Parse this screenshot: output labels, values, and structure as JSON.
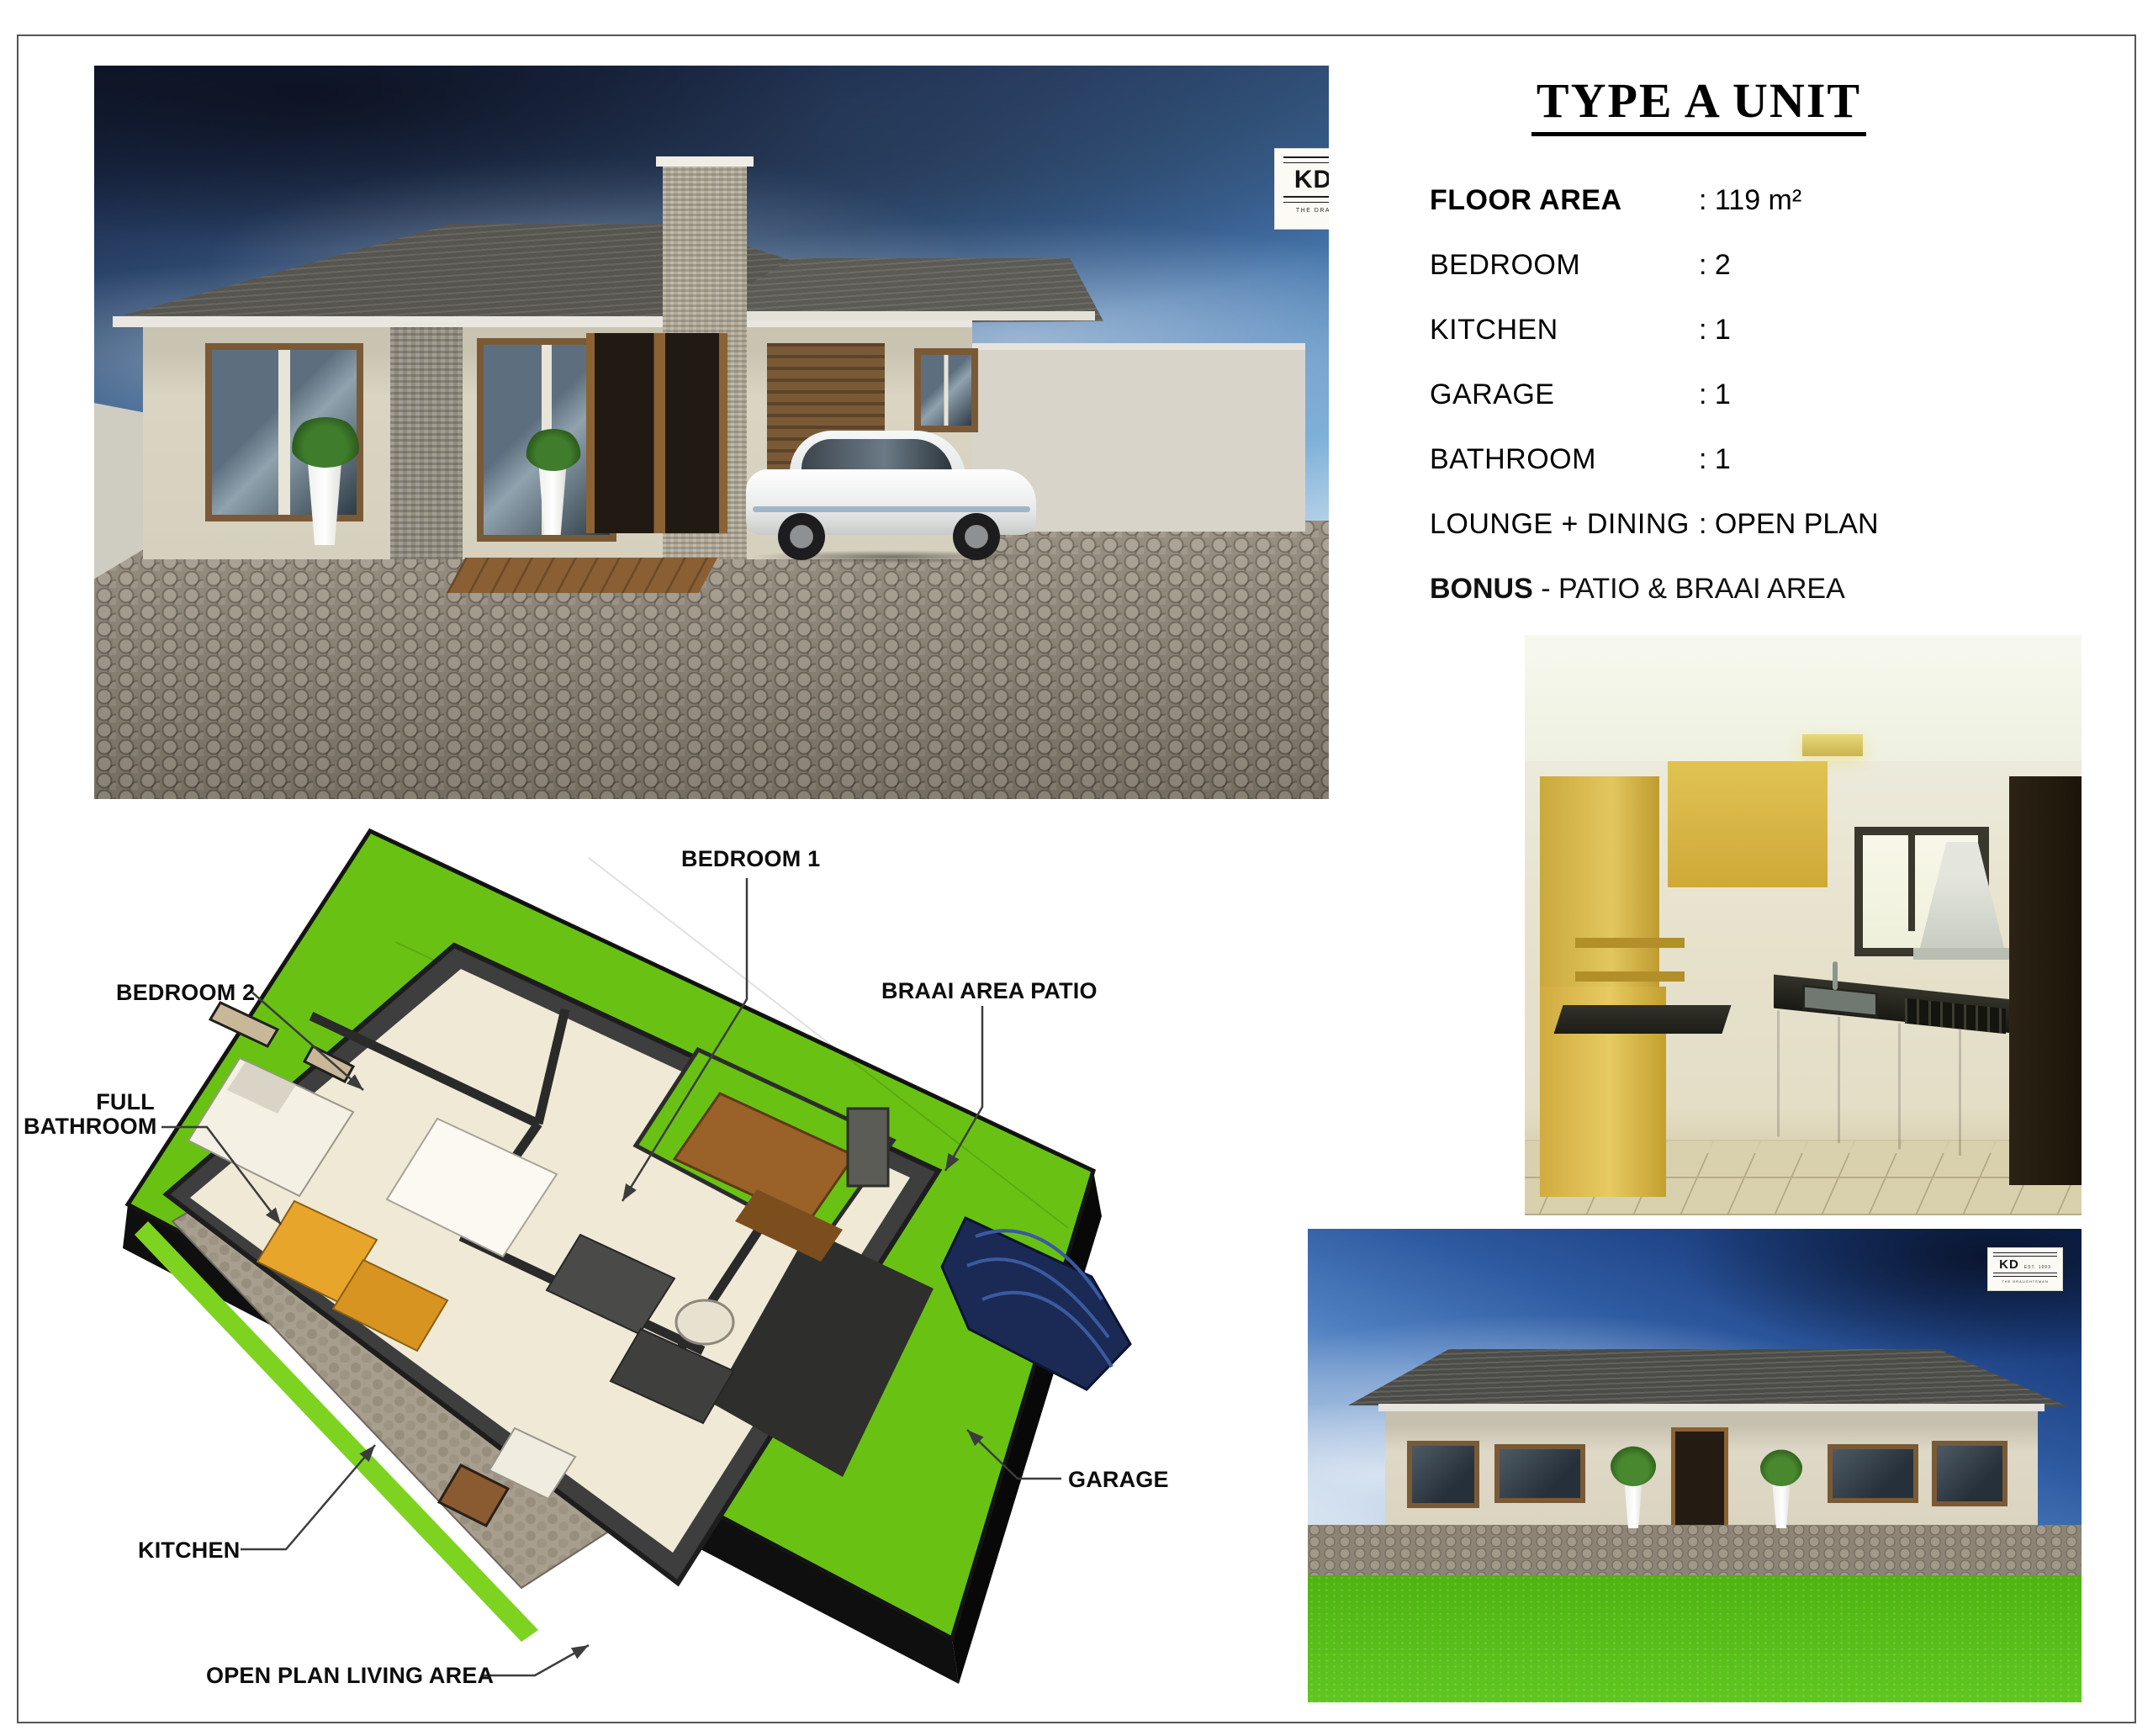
{
  "page": {
    "title": "TYPE A UNIT"
  },
  "logo": {
    "initials": "KD",
    "est": "EST. 1993",
    "tagline": "THE DRAUGHTSMAN"
  },
  "specs": {
    "rows": [
      {
        "label": "FLOOR AREA",
        "value": ": 119 m²",
        "bold": true
      },
      {
        "label": "BEDROOM",
        "value": ": 2",
        "bold": false
      },
      {
        "label": "KITCHEN",
        "value": ": 1",
        "bold": false
      },
      {
        "label": "GARAGE",
        "value": ": 1",
        "bold": false
      },
      {
        "label": "BATHROOM",
        "value": ": 1",
        "bold": false
      },
      {
        "label": "LOUNGE + DINING",
        "value": ": OPEN PLAN",
        "bold": false
      }
    ],
    "bonus_label": "BONUS",
    "bonus_text": " - PATIO & BRAAI AREA"
  },
  "floorplan": {
    "labels": {
      "bedroom1": "BEDROOM 1",
      "braai": "BRAAI AREA PATIO",
      "bedroom2": "BEDROOM 2",
      "full_bathroom_line1": "FULL",
      "full_bathroom_line2": "BATHROOM",
      "kitchen": "KITCHEN",
      "open_plan": "OPEN PLAN LIVING AREA",
      "garage": "GARAGE"
    }
  },
  "colors": {
    "lawn_green": "#69c213",
    "plan_wall": "#3e3e3e",
    "plan_floor": "#efe9d6",
    "sky_deep_blue": "#1c3f80",
    "roof_gray": "#54534e",
    "cabinet_yellow": "#d4b23e",
    "furniture_orange": "#e8a52b",
    "braai_brown": "#9a6228"
  }
}
